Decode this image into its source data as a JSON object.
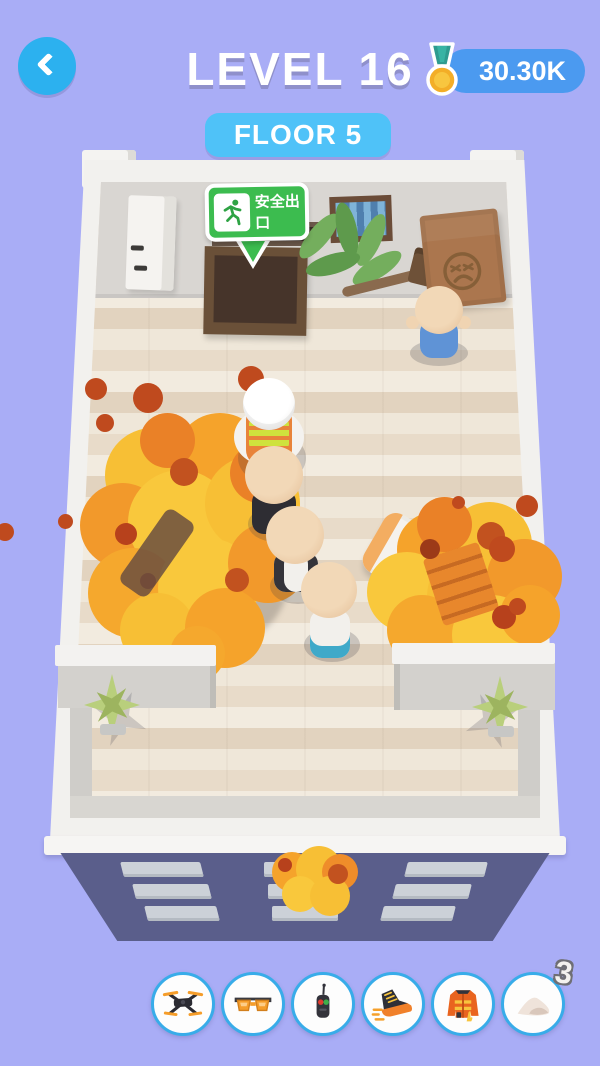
{
  "header": {
    "level_title": "LEVEL 16",
    "score": "30.30K",
    "back_icon": "chevron-left-icon",
    "score_icon": "medal-icon"
  },
  "floor_badge": {
    "label": "FLOOR 5"
  },
  "scene": {
    "exit_sign": {
      "text": "安全出口",
      "icon": "running-man-exit-icon"
    },
    "objects": [
      "fridge",
      "bookshelf",
      "picture-frame",
      "fallen-palm-plant",
      "cardboard-box",
      "burning-sofa",
      "burning-bed",
      "fire-left",
      "fire-right",
      "ember-dots",
      "firefighter-leader",
      "civilian-followers",
      "civilian-top-right",
      "potted-plant-left",
      "potted-plant-right",
      "building-facade",
      "facade-window-fire"
    ]
  },
  "items_bar": {
    "items": [
      {
        "name": "drone",
        "count": ""
      },
      {
        "name": "safety-glasses",
        "count": ""
      },
      {
        "name": "remote-control",
        "count": ""
      },
      {
        "name": "speed-sneaker",
        "count": ""
      },
      {
        "name": "fire-jacket",
        "count": ""
      },
      {
        "name": "extinguish-powder",
        "count": "3"
      }
    ]
  },
  "colors": {
    "background": "#a9adf6",
    "accent_blue": "#2cb1ef",
    "score_pill": "#4b9af0",
    "floor_pill": "#4fc2f8",
    "exit_green": "#3cbc4f",
    "fire_yellow": "#f7bf35",
    "fire_orange": "#f5a32b",
    "ember_red": "#bf4a1e",
    "facade": "#5a5e8b",
    "floor_tan": "#e8dbc9"
  }
}
